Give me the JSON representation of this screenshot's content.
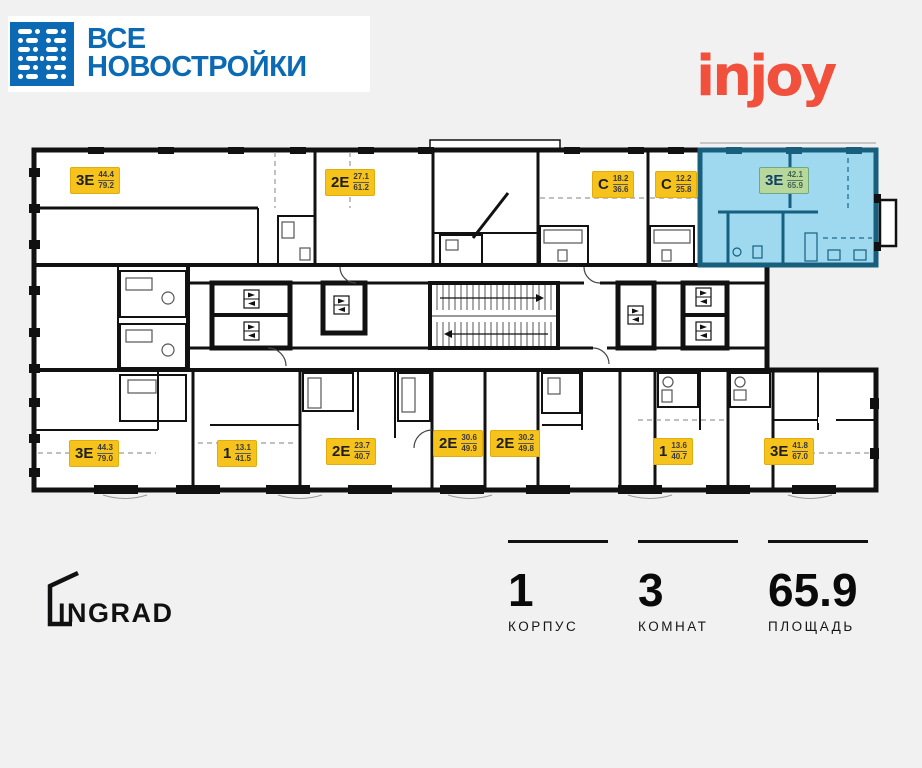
{
  "header": {
    "brand": {
      "line1": "ВСЕ",
      "line2": "НОВОСТРОЙКИ"
    },
    "complex_logo": {
      "text": "injoy"
    }
  },
  "floorplan": {
    "apartments": [
      {
        "type": "3Е",
        "area_living": "44.4",
        "area_total": "79.2",
        "highlighted": false
      },
      {
        "type": "2Е",
        "area_living": "27.1",
        "area_total": "61.2",
        "highlighted": false
      },
      {
        "type": "С",
        "area_living": "18.2",
        "area_total": "36.6",
        "highlighted": false
      },
      {
        "type": "С",
        "area_living": "12.2",
        "area_total": "25.8",
        "highlighted": false
      },
      {
        "type": "3Е",
        "area_living": "42.1",
        "area_total": "65.9",
        "highlighted": true
      },
      {
        "type": "3Е",
        "area_living": "44.3",
        "area_total": "79.0",
        "highlighted": false
      },
      {
        "type": "1",
        "area_living": "13.1",
        "area_total": "41.5",
        "highlighted": false
      },
      {
        "type": "2Е",
        "area_living": "23.7",
        "area_total": "40.7",
        "highlighted": false
      },
      {
        "type": "2Е",
        "area_living": "30.6",
        "area_total": "49.9",
        "highlighted": false
      },
      {
        "type": "2Е",
        "area_living": "30.2",
        "area_total": "49.8",
        "highlighted": false
      },
      {
        "type": "1",
        "area_living": "13.6",
        "area_total": "40.7",
        "highlighted": false
      },
      {
        "type": "3Е",
        "area_living": "41.8",
        "area_total": "67.0",
        "highlighted": false
      }
    ],
    "icons": [
      "elevator-icon",
      "stairs-icon",
      "bathtub-icon",
      "toilet-icon",
      "door-arc-icon",
      "window-mark-icon"
    ]
  },
  "developer": {
    "name": "INGRAD"
  },
  "summary": {
    "items": [
      {
        "value": "1",
        "label": "КОРПУС"
      },
      {
        "value": "3",
        "label": "КОМНАТ"
      },
      {
        "value": "65.9",
        "label": "ПЛОЩАДЬ"
      }
    ]
  },
  "colors": {
    "page_bg": "#F1F1F2",
    "brand_blue": "#0C6AB4",
    "injoy_red": "#F0503C",
    "badge_yellow": "#F6C21C",
    "highlight_fill": "#9FD9F0",
    "highlight_wall": "#175F7D",
    "highlight_badge_green": "#B7D89A",
    "plan_wall": "#111111"
  }
}
